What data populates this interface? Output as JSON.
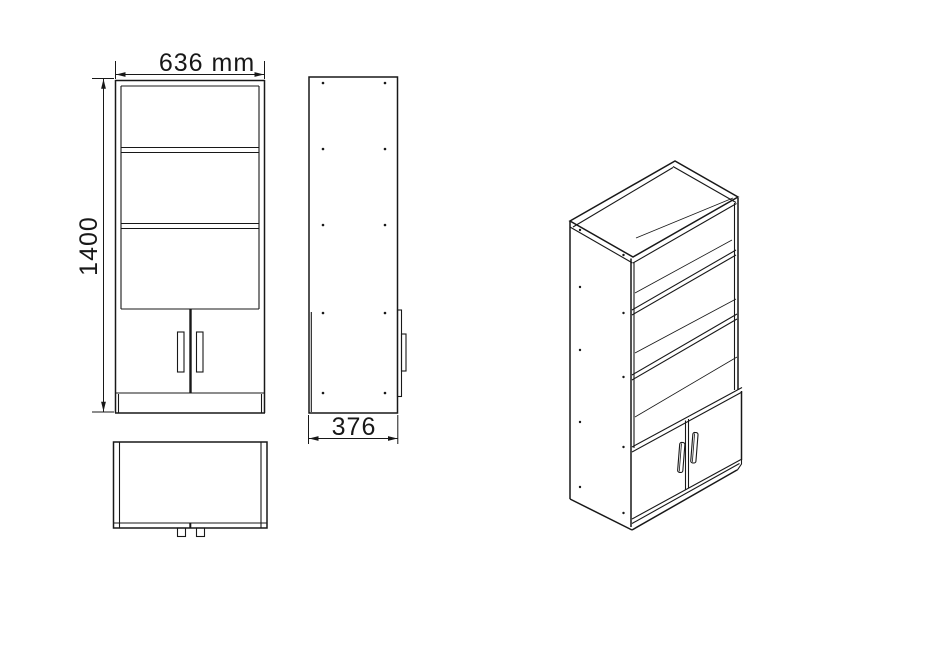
{
  "drawing": {
    "dimensions": {
      "width": {
        "label": "636 mm"
      },
      "height": {
        "label": "1400"
      },
      "depth": {
        "label": "376"
      }
    },
    "colors": {
      "line": "#181818",
      "background": "#ffffff"
    }
  }
}
